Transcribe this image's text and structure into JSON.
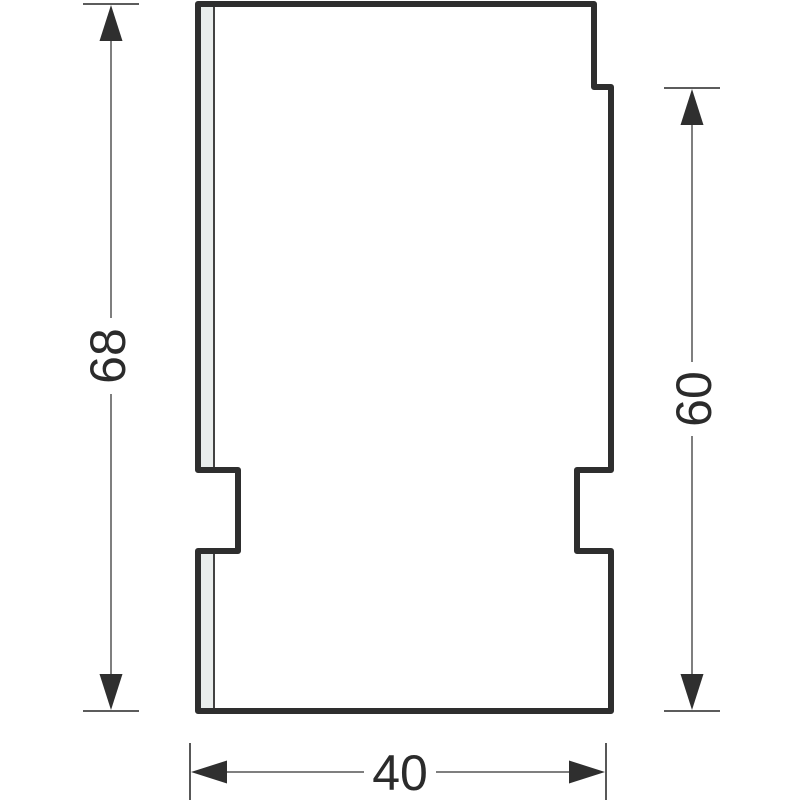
{
  "drawing": {
    "kind": "technical-dimension-drawing",
    "dimensions": {
      "total_height": {
        "value": "68",
        "orientation": "vertical",
        "side": "left"
      },
      "right_height": {
        "value": "60",
        "orientation": "vertical",
        "side": "right"
      },
      "width": {
        "value": "40",
        "orientation": "horizontal",
        "side": "bottom"
      }
    },
    "colors": {
      "background": "#ffffff",
      "part_outline": "#2e2e2e",
      "part_fill": "#ffffff",
      "edge_strip_fill": "#e9edec",
      "edge_strip_line": "#424242",
      "dimension_line": "#7f7f7f",
      "terminator_bar": "#454545",
      "arrowhead": "#2f2f2f",
      "label_text": "#2b2b2b"
    }
  }
}
